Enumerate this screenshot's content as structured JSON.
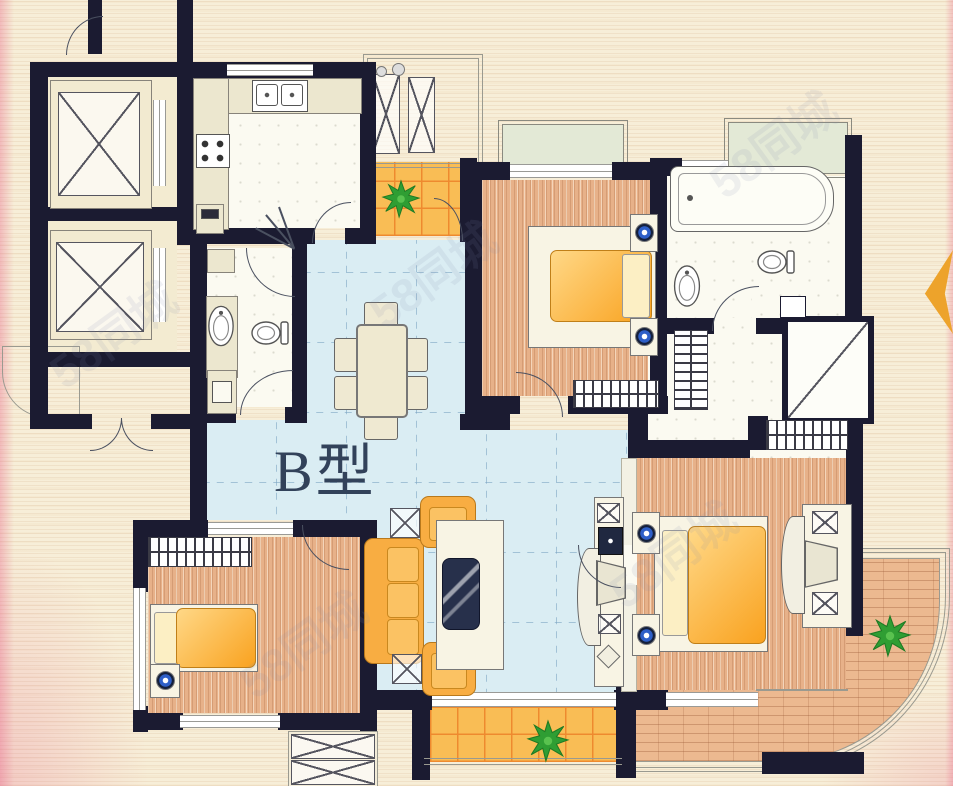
{
  "plan": {
    "type_label": "B型"
  },
  "watermark": {
    "text": "58同城"
  },
  "palette": {
    "wall": "#1b1b31",
    "paper": "#f7eed8",
    "living_floor": "#daedf3",
    "wood_floor": "#e7b189",
    "balcony_tile": "#f9bd55",
    "tile_grid": "#ee8a2f",
    "brick_paving": "#ecb990",
    "bay_window": "#e3e9d6",
    "furniture_orange": "#f8ad42",
    "blanket_orange": "#f9a21f",
    "plant_green": "#2f9e33",
    "lamp_blue": "#2e5fc8",
    "north_arrow": "#eda32b",
    "label_color": "#32425a"
  }
}
